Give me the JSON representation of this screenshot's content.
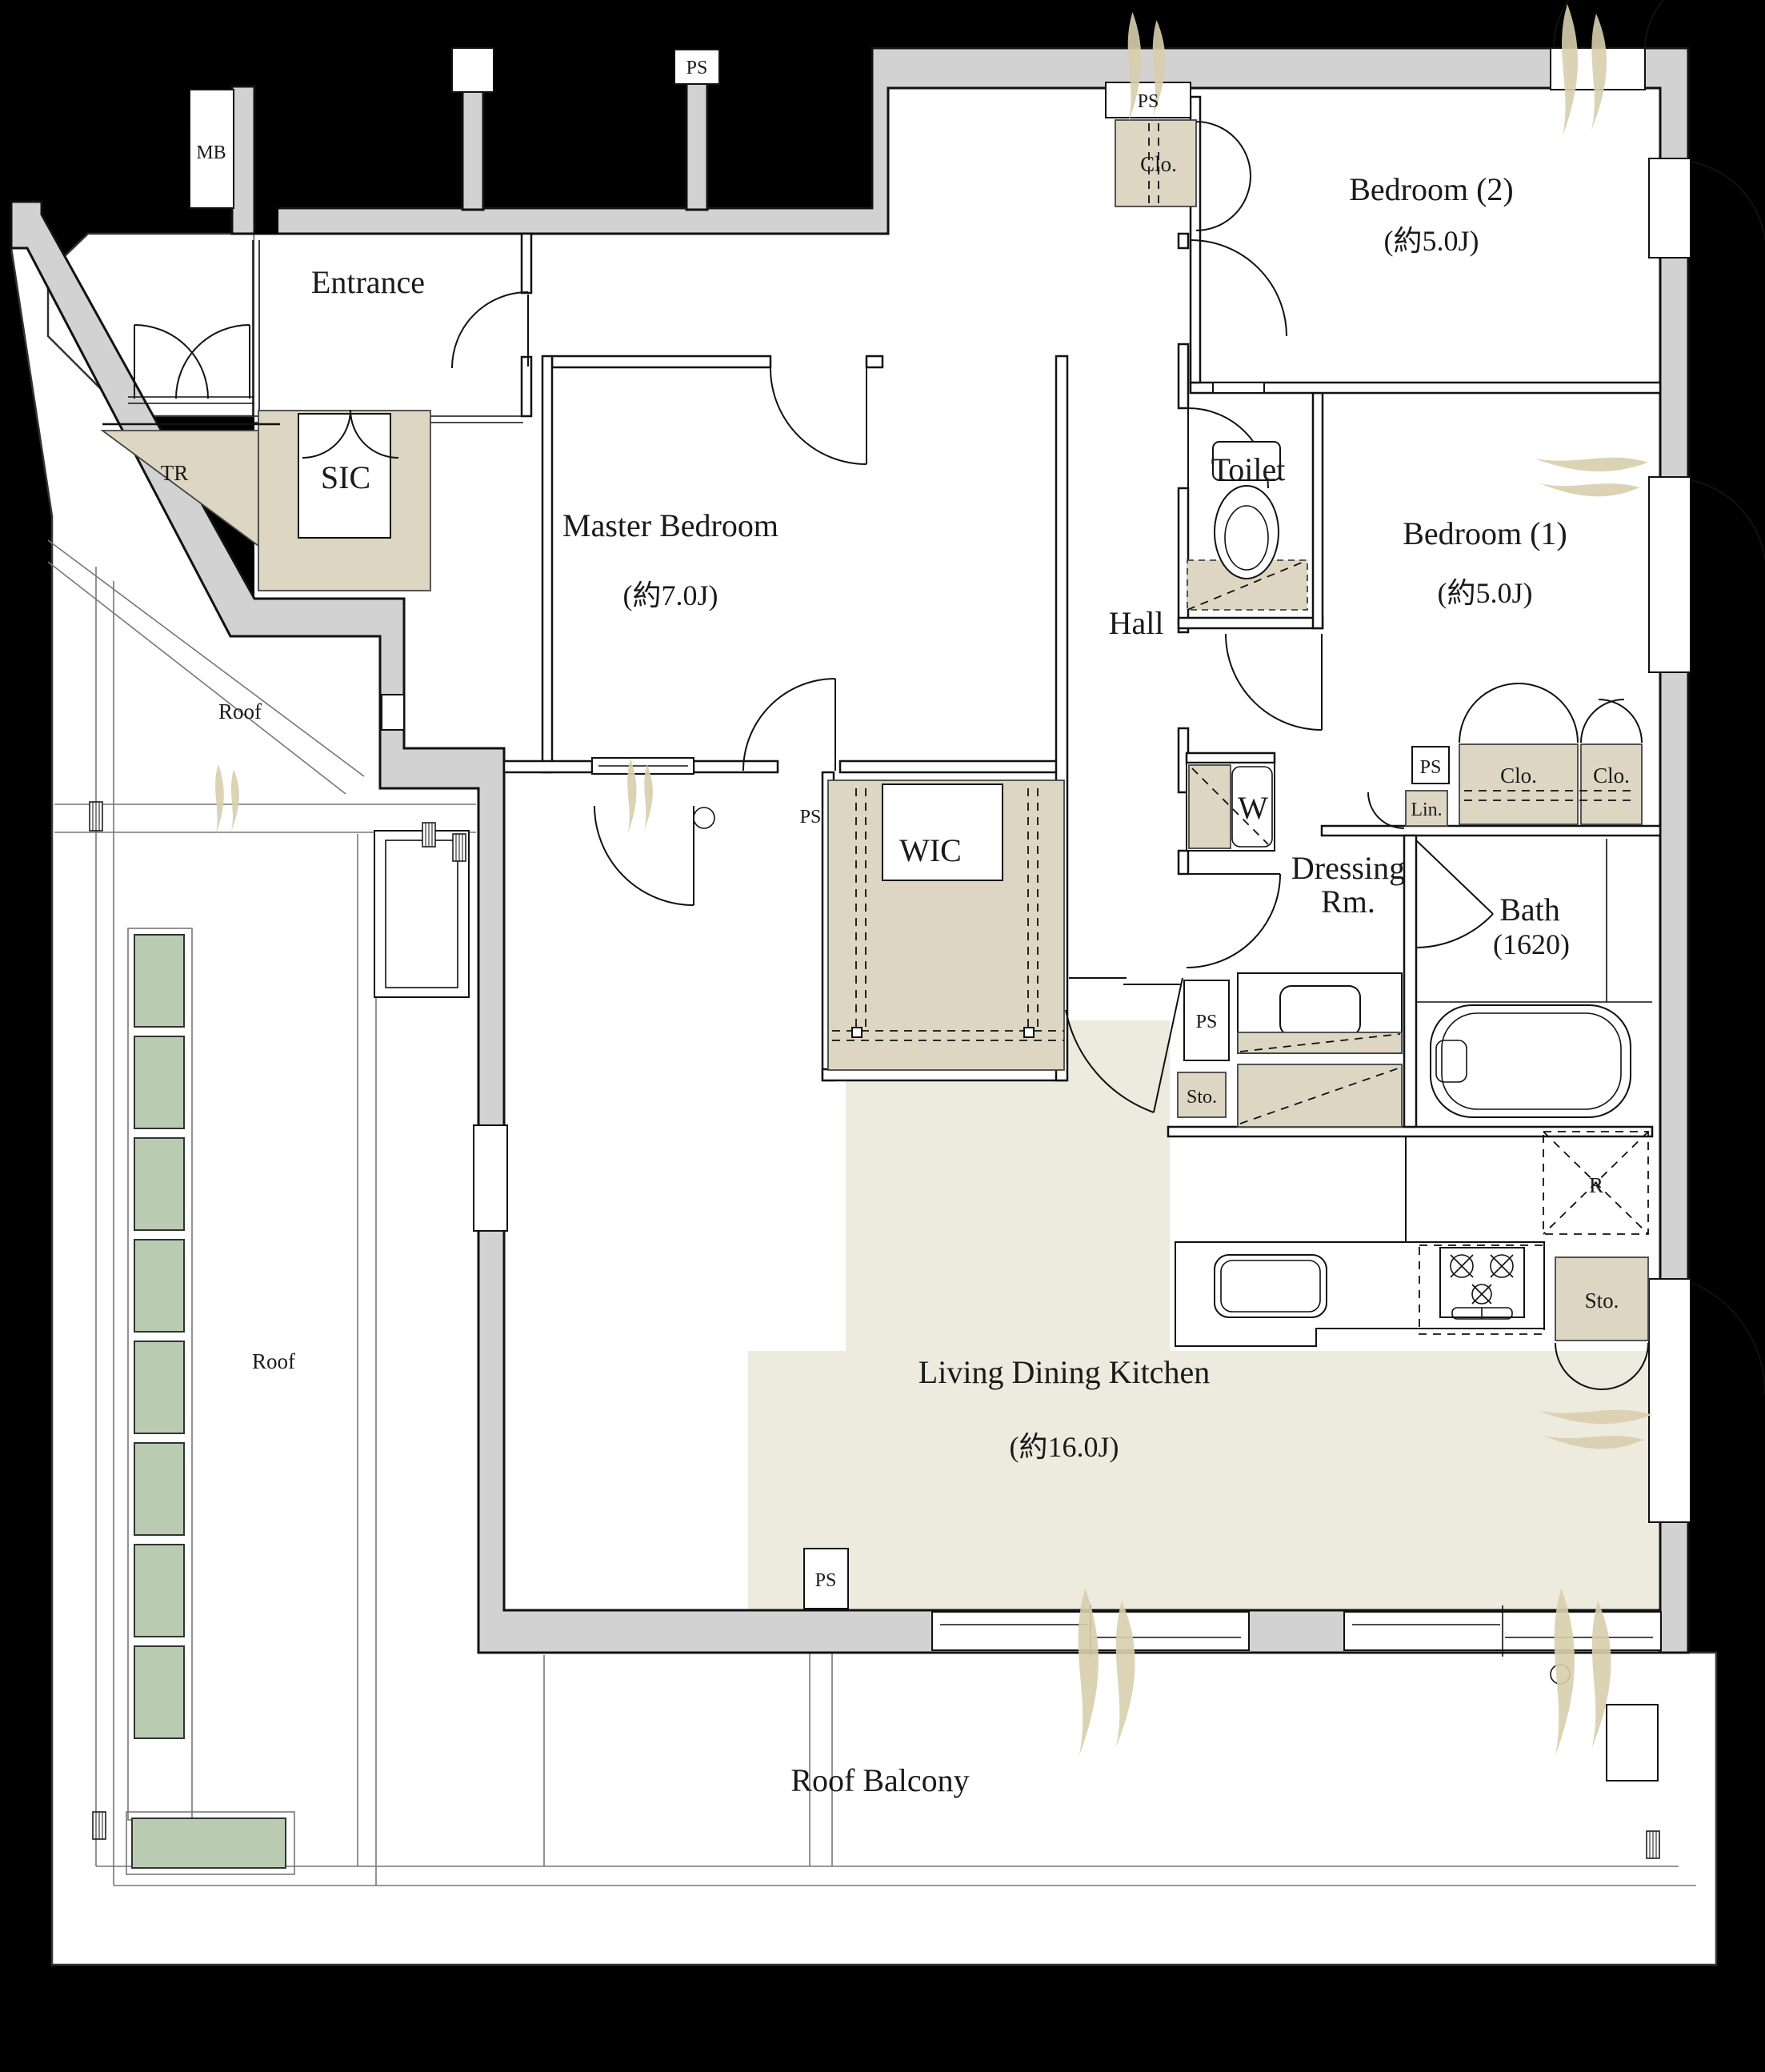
{
  "plan": {
    "type": "apartment-floor-plan",
    "rooms": {
      "entrance": {
        "label": "Entrance"
      },
      "master_bedroom": {
        "label": "Master Bedroom",
        "size": "(約7.0J)"
      },
      "bedroom1": {
        "label": "Bedroom (1)",
        "size": "(約5.0J)"
      },
      "bedroom2": {
        "label": "Bedroom (2)",
        "size": "(約5.0J)"
      },
      "ldk": {
        "label": "Living Dining Kitchen",
        "size": "(約16.0J)"
      },
      "hall": {
        "label": "Hall"
      },
      "toilet": {
        "label": "Toilet"
      },
      "bath": {
        "label": "Bath",
        "size": "(1620)"
      },
      "dressing": {
        "line1": "Dressing",
        "line2": "Rm."
      },
      "wic": {
        "label": "WIC"
      },
      "sic": {
        "label": "SIC"
      },
      "tr": {
        "label": "TR"
      },
      "roof": {
        "label": "Roof"
      },
      "roof_balcony": {
        "label": "Roof Balcony"
      }
    },
    "fixtures": {
      "mb": "MB",
      "ps": "PS",
      "clo": "Clo.",
      "lin": "Lin.",
      "sto": "Sto.",
      "washer": "W",
      "refrigerator": "R"
    },
    "colors": {
      "background": "#000000",
      "wall": "#d2d2d2",
      "closet_floor": "#ddd6c3",
      "ldk_floor": "#edeade",
      "planter_green": "#b9ccb2",
      "plant_accent": "#d9cfae"
    }
  }
}
